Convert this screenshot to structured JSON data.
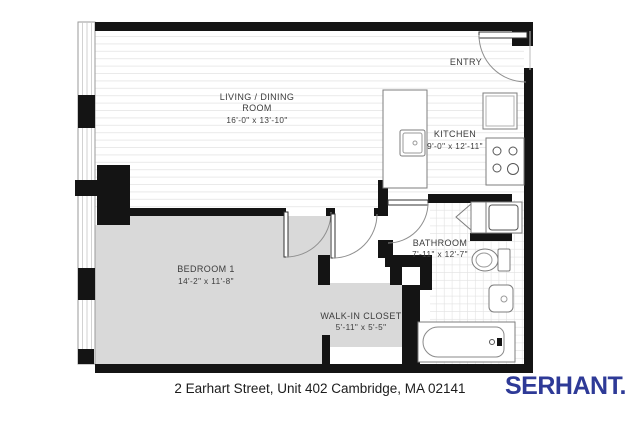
{
  "floorplan": {
    "rooms": {
      "living": {
        "line1": "LIVING / DINING",
        "line2": "ROOM",
        "dims": "16'-0\" x 13'-10\""
      },
      "kitchen": {
        "label": "KITCHEN",
        "dims": "9'-0\" x 12'-11\""
      },
      "entry": {
        "label": "ENTRY"
      },
      "bathroom": {
        "label": "BATHROOM",
        "dims": "7'-11\" x 12'-7\""
      },
      "bedroom": {
        "label": "BEDROOM 1",
        "dims": "14'-2\" x 11'-8\""
      },
      "closet": {
        "label": "WALK-IN CLOSET",
        "dims": "5'-11\" x 5'-5\""
      }
    },
    "fixtures": [
      "kitchen-sink",
      "stove",
      "refrigerator",
      "vanity-sink",
      "toilet",
      "shower-basin",
      "bathtub",
      "entry-door",
      "bedroom-door",
      "closet-door",
      "bathroom-door",
      "window-wall"
    ]
  },
  "footer": {
    "address": "2 Earhart Street, Unit 402 Cambridge, MA 02141",
    "brand": "SERHANT."
  },
  "colors": {
    "wall": "#141414",
    "bedroom_fill": "#d9d9d9",
    "brand_navy": "#2e3a97"
  }
}
